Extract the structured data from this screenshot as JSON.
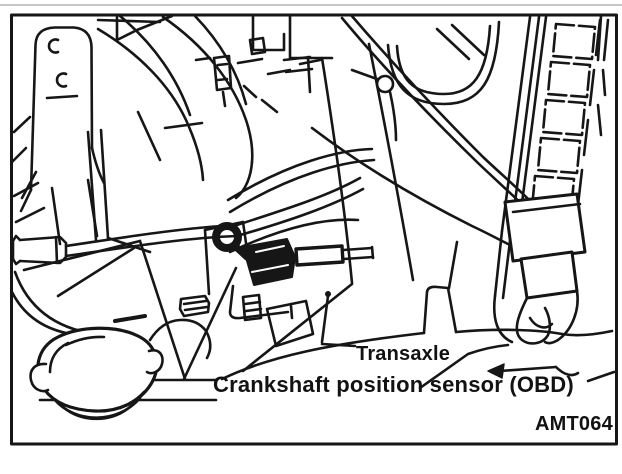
{
  "figure": {
    "kind": "service-manual-line-art",
    "labels": {
      "transaxle": "Transaxle",
      "crankshaft_sensor": "Crankshaft position sensor (OBD)"
    },
    "code": "AMT064",
    "colors": {
      "ink": "#161616",
      "background": "#ffffff",
      "top_rule": "#c8c8c8"
    },
    "drawing_elements": [
      "mounting-bracket",
      "engine-hoses",
      "corrugated-harness-duct",
      "harness-boot",
      "crankshaft-position-sensor",
      "sensor-connector-plug",
      "mounting-bolts",
      "transaxle-housing",
      "radiator-cap",
      "leader-lines",
      "pointer-arrow"
    ]
  }
}
